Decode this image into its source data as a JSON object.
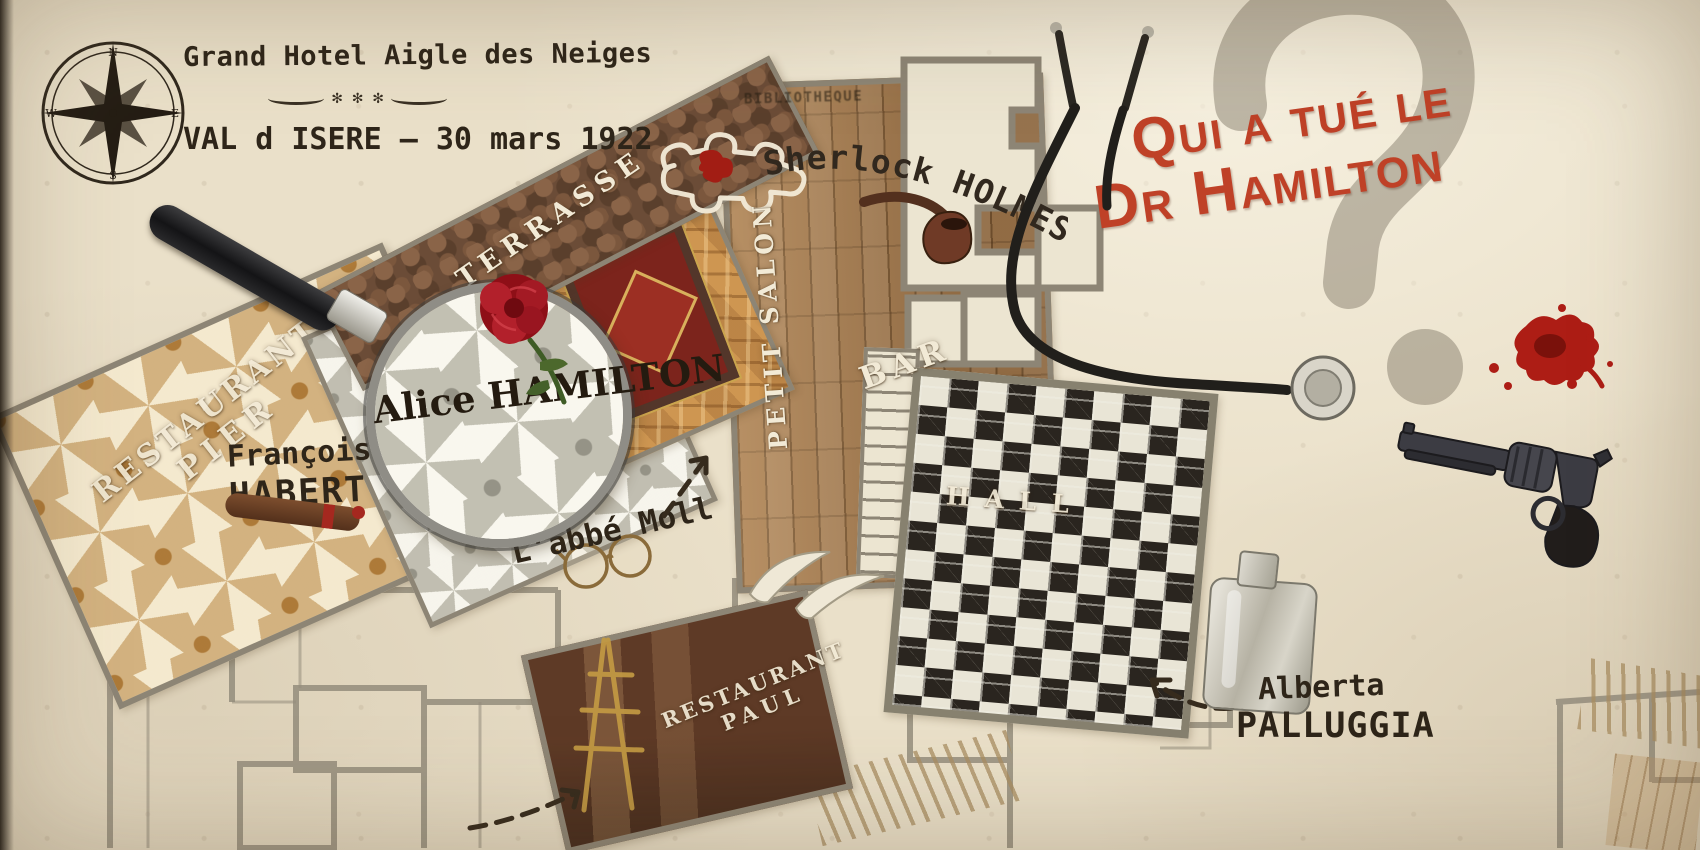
{
  "header": {
    "hotel_name": "Grand Hotel Aigle des Neiges",
    "ornament": "✻ ✻ ✻",
    "location_date": "VAL d ISERE – 30 mars 1922"
  },
  "title": {
    "line1": "Qui a tué le",
    "line2": "Dr Hamilton",
    "question_mark": "?"
  },
  "rooms": {
    "terrasse": "TERRASSE",
    "petit_salon": "PETIT SALON",
    "bar": "BAR",
    "hall": "HALL",
    "restaurant_pier": [
      "RESTAURANT",
      "PIER"
    ],
    "restaurant_paul": [
      "RESTAURANT",
      "PAUL"
    ],
    "faint_label": "BIBLIOTHEQUE"
  },
  "suspects": {
    "alice": "Alice HAMILTON",
    "francois_first": "François",
    "francois_last": "HABERT",
    "sherlock": "Sherlock HOLMES",
    "abbe": "L'abbé Moll",
    "alberta_first": "Alberta",
    "alberta_last": "PALLUGGIA"
  },
  "props": {
    "compass_points": [
      "N",
      "E",
      "S",
      "W"
    ],
    "compass": "compass-rose",
    "magnifier": "magnifying-glass",
    "rose": "red-rose",
    "pipe": "smoking-pipe",
    "stethoscope": "stethoscope",
    "revolver": "revolver",
    "flask": "hip-flask",
    "cigar": "cigar",
    "blood": "blood-splatter",
    "body": "chalk-body-outline",
    "glasses": "spectacles-doodle",
    "easel": "easel-sketch"
  },
  "colors": {
    "paper": "#eae0c9",
    "accent_red": "#bf4127",
    "wall_gray": "#8d8575",
    "wood": "#a97d4f",
    "dark_room": "#5e3a26",
    "ink": "#2e2519"
  }
}
